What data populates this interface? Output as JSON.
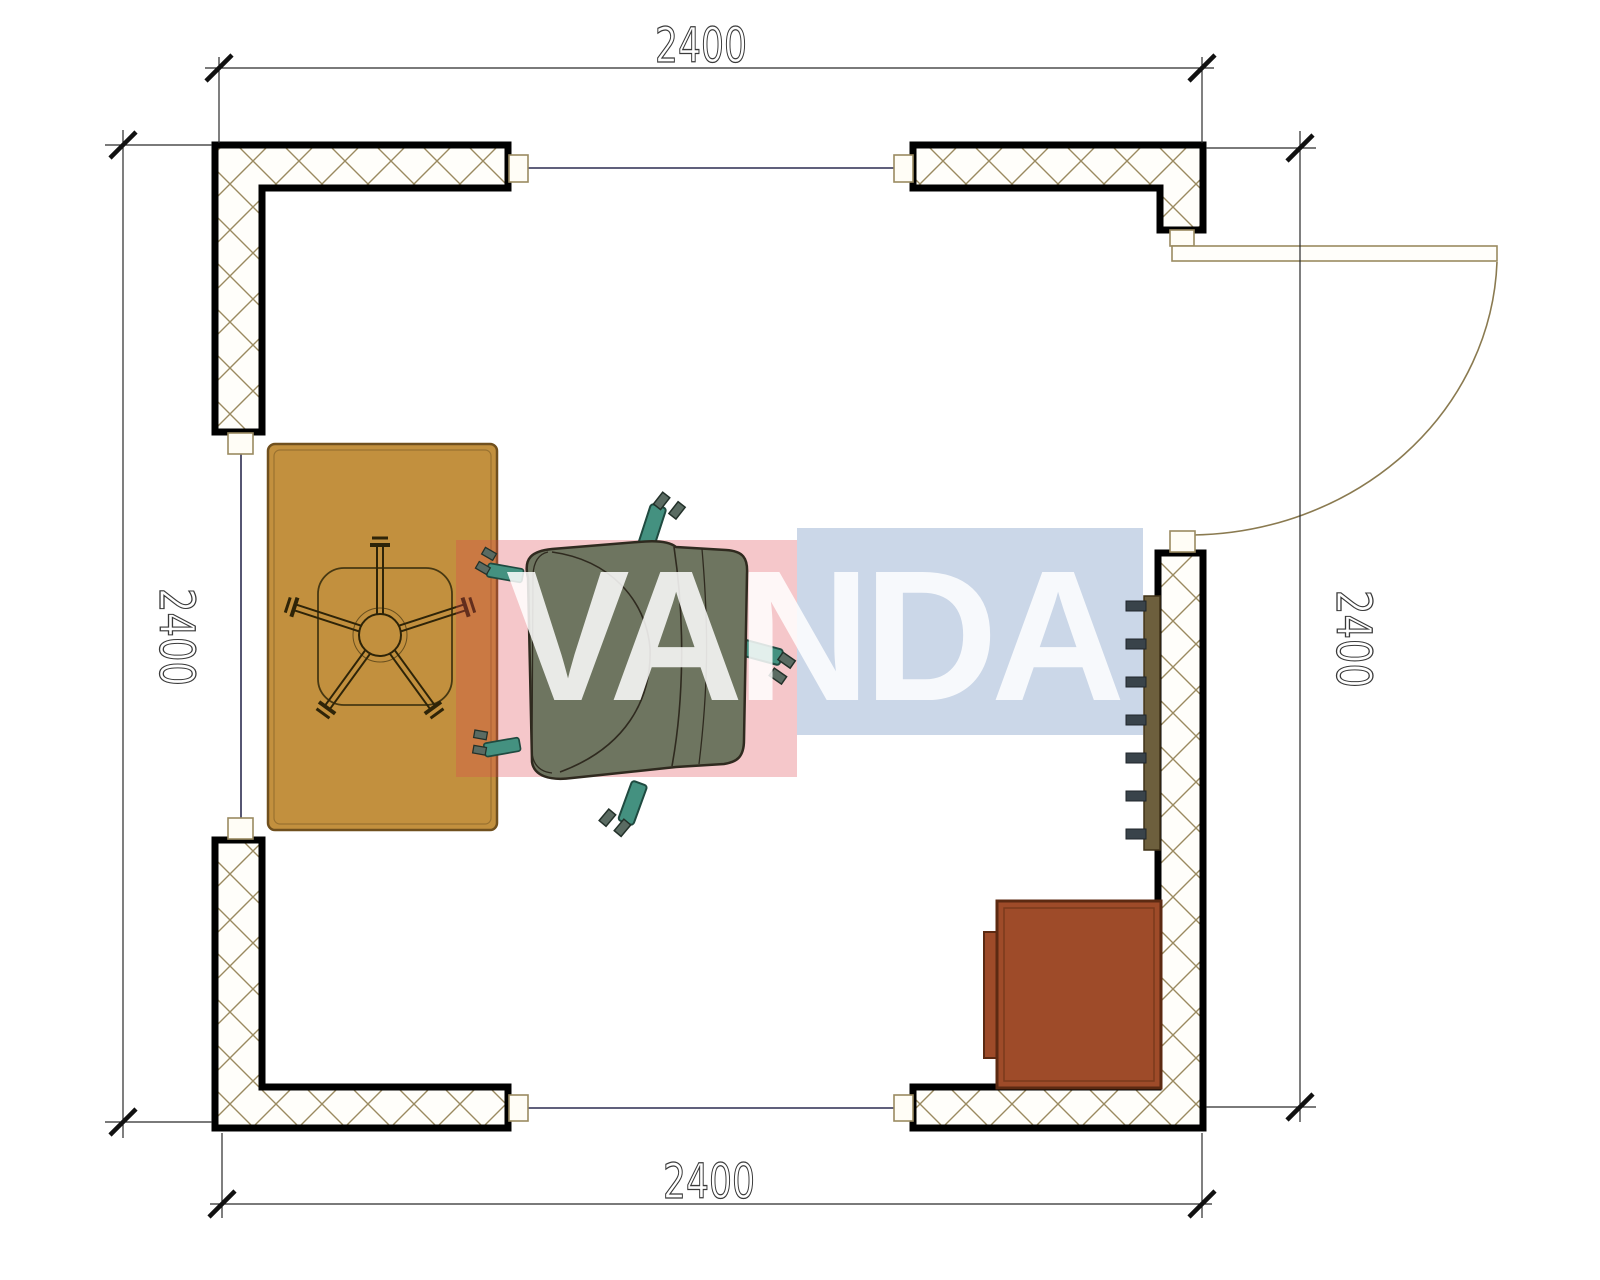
{
  "plan": {
    "dimension_labels": {
      "top": "2400",
      "bottom": "2400",
      "left": "2400",
      "right": "2400"
    }
  },
  "watermark": {
    "text": "VANDA",
    "red_block_color": "#df4650",
    "blue_block_color": "#6e91be"
  },
  "colors": {
    "wall_outline": "#000000",
    "hatch_line": "#9a8a60",
    "desk": "#c2903e",
    "desk_border": "#70501e",
    "chair_body": "#6e7560",
    "chair_leg": "#449180",
    "radiator": "#6d5f3d",
    "radiator_fin": "#39434a",
    "cabinet": "#9e4b29",
    "cabinet_border": "#5c2a12",
    "dimension": "#3a3a3a",
    "glazing": "#2c2c50"
  }
}
